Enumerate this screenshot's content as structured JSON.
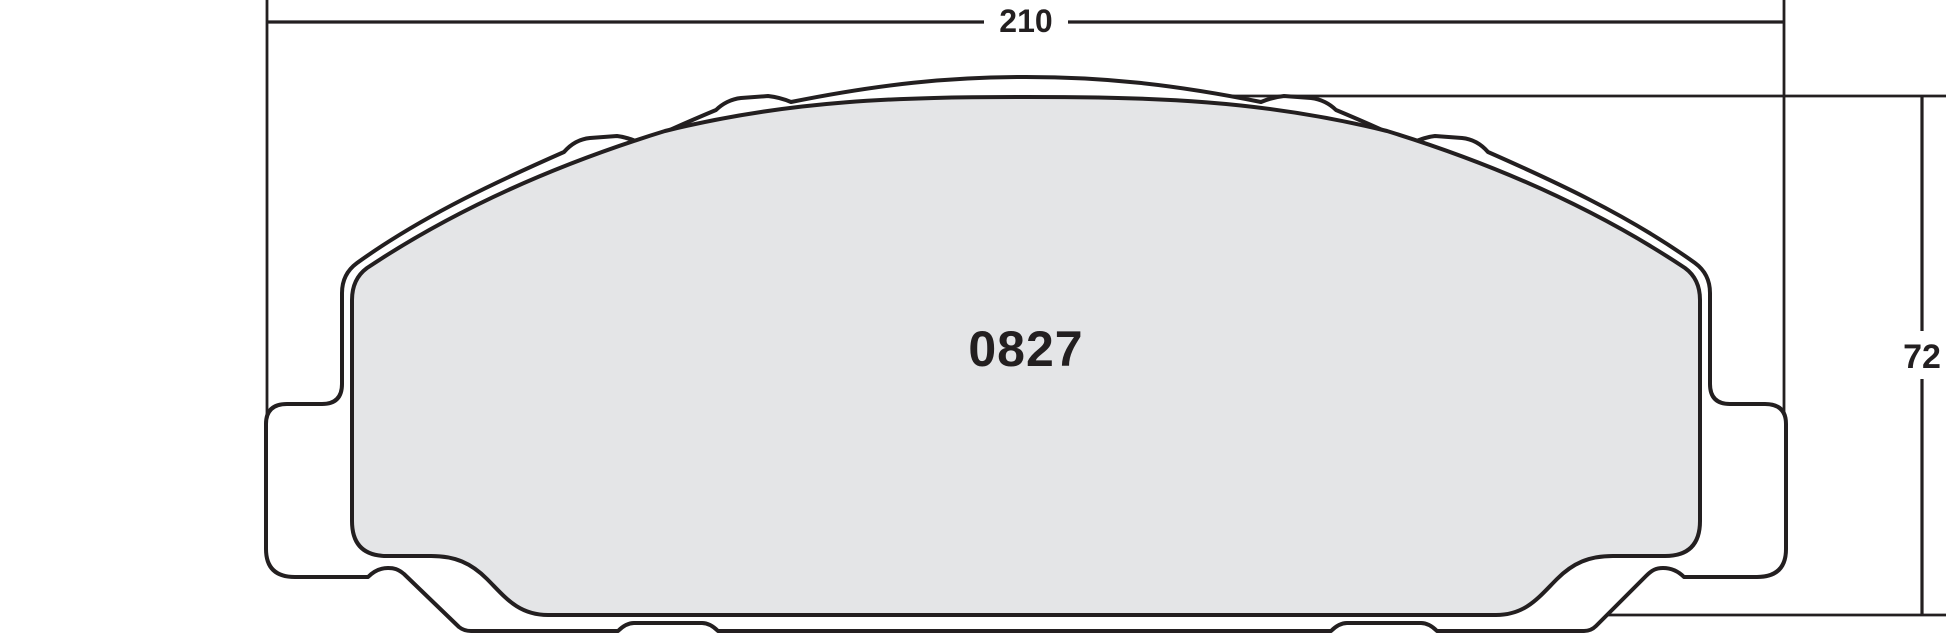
{
  "drawing": {
    "title": "brake-pad-outline-drawing",
    "part_number": "0827",
    "dimensions": {
      "width": "210",
      "height": "72"
    },
    "colors": {
      "outline": "#231f20",
      "friction_material_fill": "#e4e5e7",
      "background": "#ffffff"
    }
  }
}
